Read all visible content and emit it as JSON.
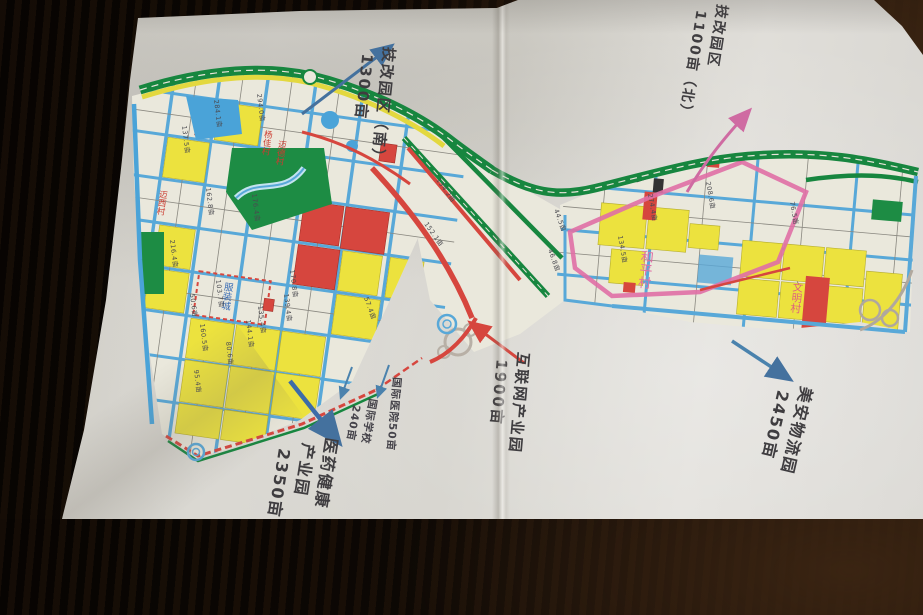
{
  "annotations": {
    "tech_south": {
      "line1": "技改园区（南）",
      "line2": "1300亩"
    },
    "tech_north": {
      "line1": "技改园区",
      "line2": "1100亩（北）"
    },
    "internet": {
      "line1": "互联网产业园",
      "line2": "1900亩"
    },
    "meian": {
      "line1": "美安物流园",
      "line2": "2450亩"
    },
    "pharma": {
      "line1": "医药健康",
      "line2": "产业园",
      "line3": "2350亩"
    },
    "hospital": {
      "line1": "国际医院50亩"
    },
    "school": {
      "line1": "国际学校",
      "line2": "240亩"
    }
  },
  "map": {
    "villages": {
      "heping": "和平村",
      "wenming": "文明村",
      "yangjia": "杨佳村",
      "maide": "迈德村",
      "shaxi": "迈西村"
    },
    "zone_box_label": "服装城",
    "parcel_labels": [
      {
        "t": "284.1亩",
        "x": 214,
        "y": 100,
        "r": 83
      },
      {
        "t": "294.0亩",
        "x": 257,
        "y": 94,
        "r": 83
      },
      {
        "t": "137.5亩",
        "x": 182,
        "y": 126,
        "r": 83
      },
      {
        "t": "162.8亩",
        "x": 206,
        "y": 188,
        "r": 83
      },
      {
        "t": "176.4亩",
        "x": 252,
        "y": 194,
        "r": 83
      },
      {
        "t": "216.4亩",
        "x": 170,
        "y": 240,
        "r": 83
      },
      {
        "t": "103.7亩",
        "x": 216,
        "y": 280,
        "r": 83
      },
      {
        "t": "50.6亩",
        "x": 190,
        "y": 294,
        "r": 83
      },
      {
        "t": "160.5亩",
        "x": 200,
        "y": 324,
        "r": 83
      },
      {
        "t": "80.6亩",
        "x": 226,
        "y": 342,
        "r": 83
      },
      {
        "t": "135.4亩",
        "x": 258,
        "y": 306,
        "r": 83
      },
      {
        "t": "144.1亩",
        "x": 246,
        "y": 320,
        "r": 83
      },
      {
        "t": "139.4亩",
        "x": 284,
        "y": 294,
        "r": 83
      },
      {
        "t": "170.8亩",
        "x": 290,
        "y": 270,
        "r": 83
      },
      {
        "t": "95.4亩",
        "x": 194,
        "y": 370,
        "r": 83
      },
      {
        "t": "57.4亩",
        "x": 364,
        "y": 298,
        "r": 70
      },
      {
        "t": "134.2亩",
        "x": 436,
        "y": 180,
        "r": 55
      },
      {
        "t": "152.1亩",
        "x": 424,
        "y": 224,
        "r": 55
      },
      {
        "t": "44.5亩",
        "x": 554,
        "y": 210,
        "r": 70
      },
      {
        "t": "274.4亩",
        "x": 648,
        "y": 194,
        "r": 80
      },
      {
        "t": "208.6亩",
        "x": 706,
        "y": 182,
        "r": 80
      },
      {
        "t": "76.5亩",
        "x": 790,
        "y": 202,
        "r": 80
      },
      {
        "t": "134.5亩",
        "x": 618,
        "y": 236,
        "r": 80
      },
      {
        "t": "46.8亩",
        "x": 548,
        "y": 250,
        "r": 70
      }
    ]
  },
  "colors": {
    "paper": "#d8d6d0",
    "wood": "#140d07",
    "parcel_yellow": "#ece23e",
    "parcel_red": "#d6463e",
    "park_green": "#1d8c44",
    "road_green": "#17863f",
    "road_blue": "#58a8d8",
    "road_red": "#d6463e",
    "boundary_pink": "#e06fa5",
    "annotation_ink": "#3f3d40",
    "arrow_blue": "#44719e",
    "arrow_pink": "#cf6ba2",
    "arrow_red": "#d6463e"
  }
}
